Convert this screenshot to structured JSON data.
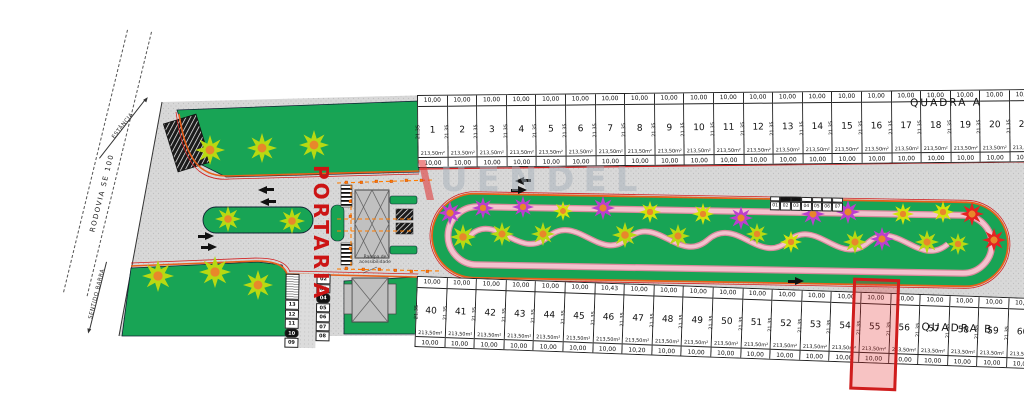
{
  "watermark": {
    "text": "UENDEL"
  },
  "left_roads": {
    "rodovia_label": "RODOVIA SE 100",
    "direction_top": "ESTÂNCIA",
    "direction_bottom": "SENTIDO BARRA"
  },
  "entrance": {
    "portaria_label": "PORTARIA",
    "ramp_note_line1": "Rampa de",
    "ramp_note_line2": "acessibilidade"
  },
  "lot_defaults": {
    "front": "10,00",
    "back": "10,00",
    "side": "21,35",
    "area": "213,50m²"
  },
  "quadra_a": {
    "label": "QUADRA A",
    "lots": [
      {
        "n": "1"
      },
      {
        "n": "2"
      },
      {
        "n": "3"
      },
      {
        "n": "4"
      },
      {
        "n": "5"
      },
      {
        "n": "6"
      },
      {
        "n": "7"
      },
      {
        "n": "8"
      },
      {
        "n": "9"
      },
      {
        "n": "10"
      },
      {
        "n": "11"
      },
      {
        "n": "12"
      },
      {
        "n": "13"
      },
      {
        "n": "14"
      },
      {
        "n": "15"
      },
      {
        "n": "16"
      },
      {
        "n": "17"
      },
      {
        "n": "18"
      },
      {
        "n": "19"
      },
      {
        "n": "20"
      },
      {
        "n": "21"
      }
    ]
  },
  "quadra_b": {
    "label": "QUADRA B",
    "lots": [
      {
        "n": "40"
      },
      {
        "n": "41"
      },
      {
        "n": "42"
      },
      {
        "n": "43"
      },
      {
        "n": "44"
      },
      {
        "n": "45"
      },
      {
        "n": "46",
        "front": "10,43"
      },
      {
        "n": "47",
        "back": "10,20"
      },
      {
        "n": "48"
      },
      {
        "n": "49"
      },
      {
        "n": "50"
      },
      {
        "n": "51"
      },
      {
        "n": "52"
      },
      {
        "n": "53"
      },
      {
        "n": "54"
      },
      {
        "n": "55"
      },
      {
        "n": "56"
      },
      {
        "n": "57"
      },
      {
        "n": "58"
      },
      {
        "n": "59"
      },
      {
        "n": "60"
      }
    ]
  },
  "highlight": {
    "lot": "55"
  },
  "mini_strip": {
    "left": [
      "13",
      "12",
      "11",
      "10",
      "09"
    ],
    "left_inverted": "10",
    "right": [
      "02",
      "03",
      "04",
      "05",
      "06",
      "07",
      "08"
    ],
    "right_inverted": "04"
  },
  "median_strip": {
    "cells": [
      "01",
      "02",
      "03",
      "04",
      "05",
      "06",
      "07"
    ]
  },
  "colors": {
    "grass": "#18a455",
    "road": "#d8d8d8",
    "curb_orange": "#e8601c",
    "curb_red": "#d42222",
    "path_pink": "#f4c2ce",
    "highlight_red": "#cf1d1d",
    "portaria_red": "#cc1414",
    "tree_lime": "#b8d912",
    "tree_purple": "#bb3fcf",
    "tree_yellow": "#d3e30c",
    "tree_red": "#e42222",
    "cone_orange": "#ff7d00"
  }
}
